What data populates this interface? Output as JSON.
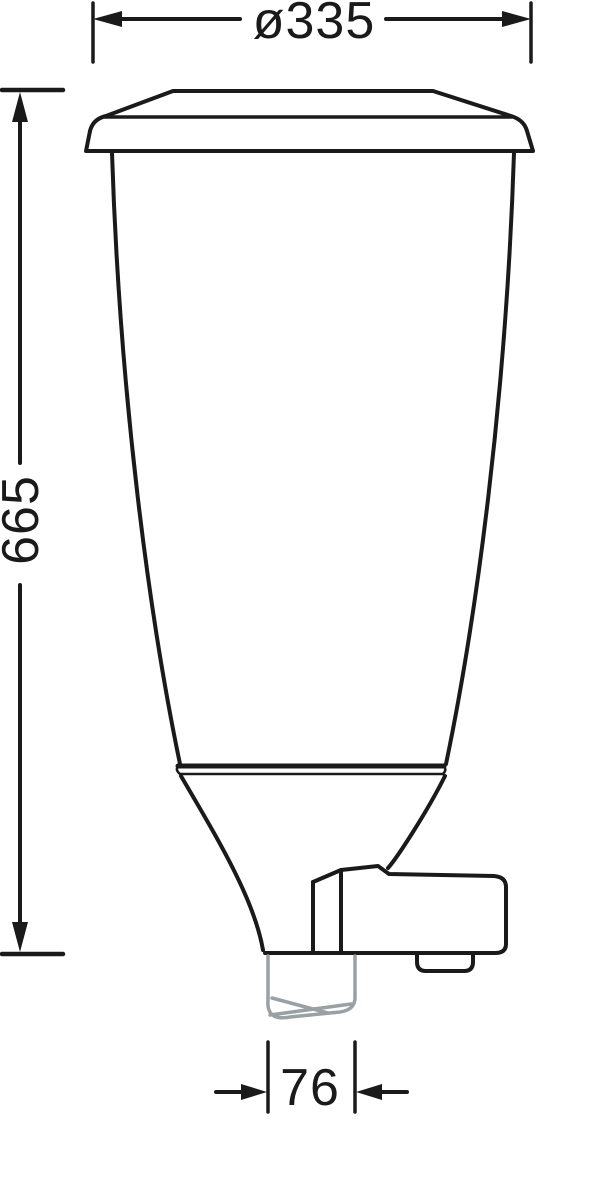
{
  "drawing": {
    "type": "technical-dimension-drawing",
    "subject": "hopper-dispenser-side-view",
    "dimensions": {
      "top_diameter": "ø335",
      "overall_height": "665",
      "outlet_width": "76"
    },
    "colors": {
      "line_color": "#1a1a1a",
      "spout_color": "#99a1a4",
      "background_color": "#ffffff"
    }
  }
}
